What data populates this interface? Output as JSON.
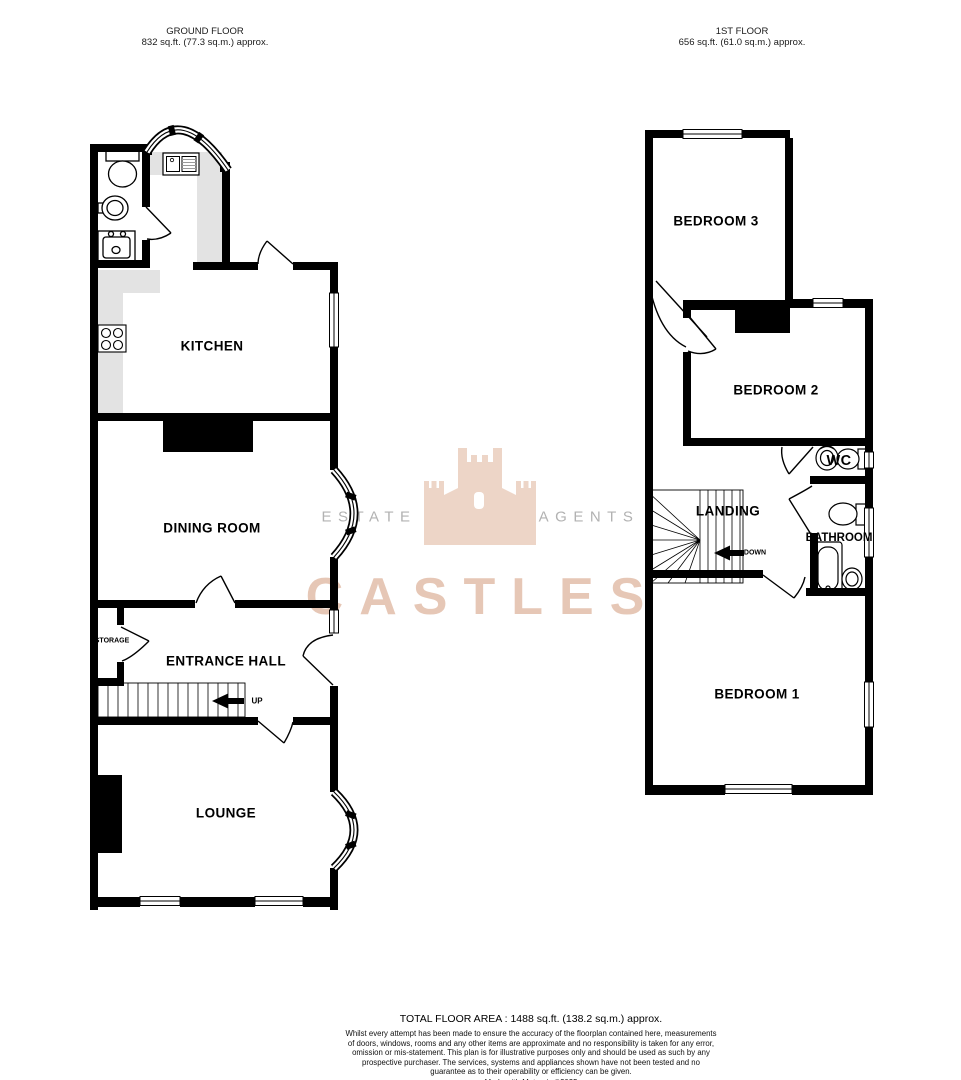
{
  "header": {
    "ground_floor": {
      "title": "GROUND FLOOR",
      "area": "832 sq.ft. (77.3 sq.m.) approx."
    },
    "first_floor": {
      "title": "1ST FLOOR",
      "area": "656 sq.ft. (61.0 sq.m.) approx."
    }
  },
  "ground_floor": {
    "rooms": {
      "kitchen": "KITCHEN",
      "dining_room": "DINING ROOM",
      "entrance_hall": "ENTRANCE HALL",
      "lounge": "LOUNGE",
      "storage": "STORAGE",
      "stairs_direction": "UP"
    }
  },
  "first_floor": {
    "rooms": {
      "bedroom3": "BEDROOM 3",
      "bedroom2": "BEDROOM 2",
      "wc": "WC",
      "landing": "LANDING",
      "bathroom": "BATHROOM",
      "bedroom1": "BEDROOM 1",
      "stairs_direction": "DOWN"
    }
  },
  "watermark": {
    "left_word": "ESTATE",
    "right_word": "AGENTS",
    "brand": "CASTLES"
  },
  "footer": {
    "total": "TOTAL FLOOR AREA : 1488 sq.ft. (138.2 sq.m.) approx.",
    "disclaimer": "Whilst every attempt has been made to ensure the accuracy of the floorplan contained here, measurements of doors, windows, rooms and any other items are approximate and no responsibility is taken for any error, omission or mis-statement. This plan is for illustrative purposes only and should be used as such by any prospective purchaser. The services, systems and appliances shown have not been tested and no guarantee as to their operability or efficiency can be given.",
    "credit": "Made with Metropix ©2025"
  },
  "icons": {
    "fixtures": [
      "toilet-icon",
      "basin-icon",
      "butler-sink-icon",
      "kitchen-sink-icon",
      "hob-icon",
      "bath-icon"
    ],
    "arrows": [
      "up-arrow-icon",
      "down-arrow-icon"
    ],
    "logo": "castle-logo-icon"
  },
  "colors": {
    "wall": "#000000",
    "counter": "#e3e3e3",
    "watermark_tan": "#dfb39a",
    "watermark_grey": "#b2b2b2",
    "background": "#ffffff"
  }
}
